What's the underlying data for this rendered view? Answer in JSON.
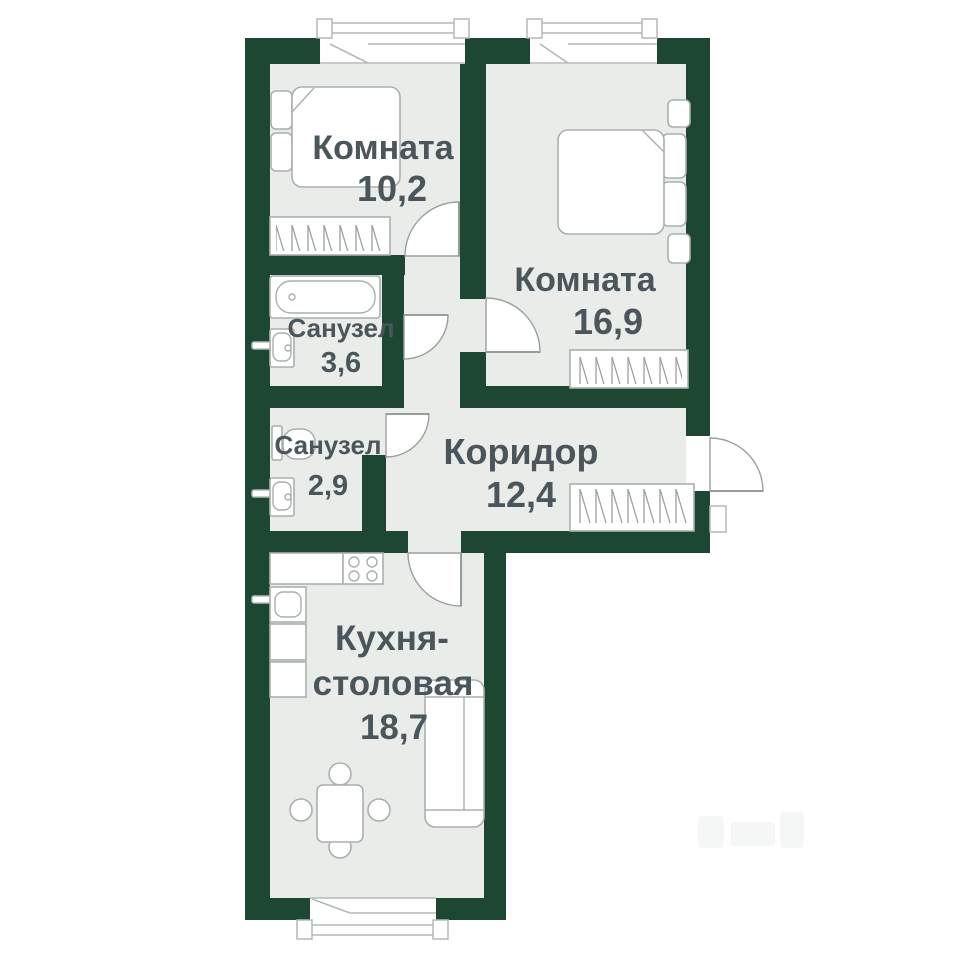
{
  "page": {
    "type": "apartment-floor-plan",
    "background": "#ffffff"
  },
  "colors": {
    "wall": "#1e4733",
    "floor": "#e9ece8",
    "furniture_line": "#a9b0ad",
    "door_line": "#99a09d",
    "text": "#4a565b"
  },
  "rooms": [
    {
      "name": "room-small",
      "label": "Комната",
      "area": "10,2"
    },
    {
      "name": "room-large",
      "label": "Комната",
      "area": "16,9"
    },
    {
      "name": "bathroom-large",
      "label": "Санузел",
      "area": "3,6"
    },
    {
      "name": "bathroom-small",
      "label": "Санузел",
      "area": "2,9"
    },
    {
      "name": "corridor",
      "label": "Коридор",
      "area": "12,4"
    },
    {
      "name": "kitchen-dining",
      "line1": "Кухня-",
      "line2": "столовая",
      "area": "18,7"
    }
  ]
}
